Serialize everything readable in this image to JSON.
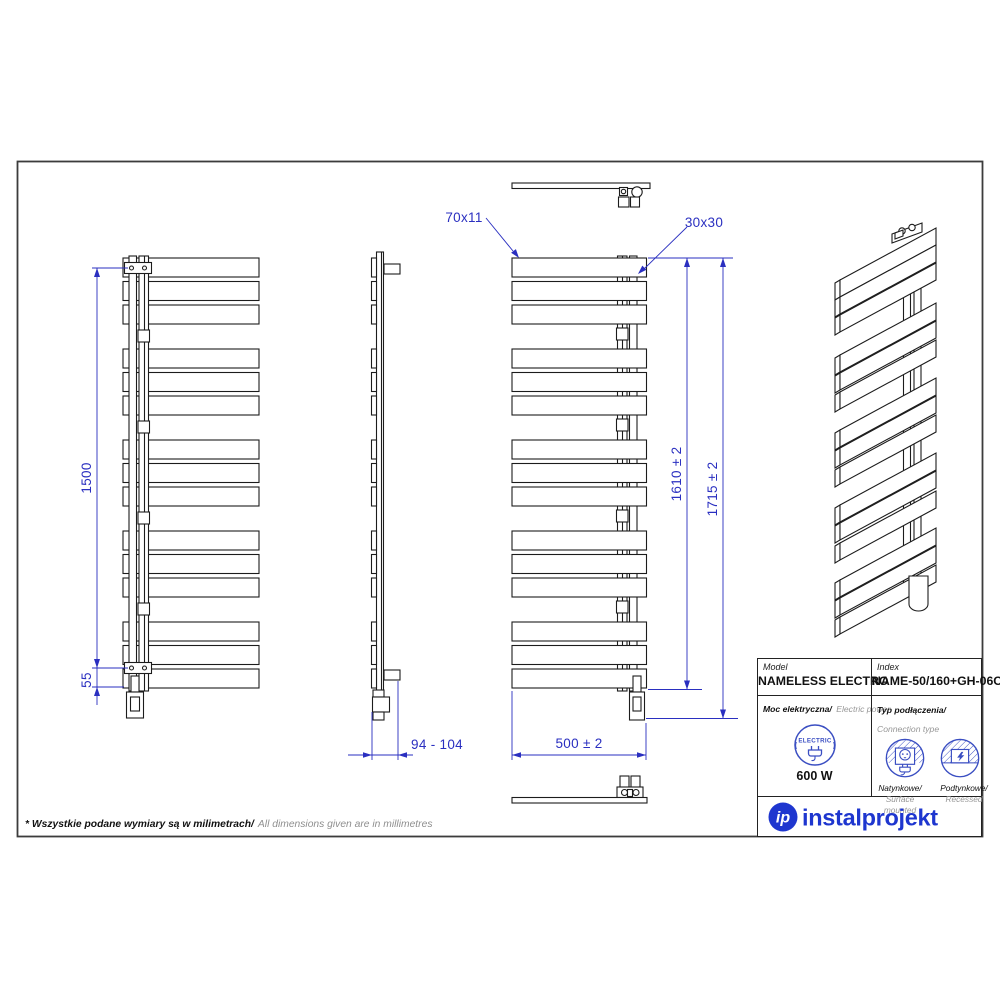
{
  "dimensions": {
    "mounting_height": "1500",
    "bottom_offset": "55",
    "wall_distance": "94 - 104",
    "width": "500 ± 2",
    "body_height": "1610 ± 2",
    "total_height": "1715 ± 2",
    "panel_profile": "70x11",
    "collector_profile": "30x30"
  },
  "title_block": {
    "model_label": "Model",
    "model_value": "NAMELESS ELECTRO",
    "index_label": "Index",
    "index_value": "NAME-50/160+GH-06C1",
    "power_label_pl": "Moc elektryczna/",
    "power_label_en": "Electric power",
    "electric_badge": "ELECTRIC",
    "power_value": "600 W",
    "connection_label_pl": "Typ podłączenia/",
    "connection_label_en": "Connection type",
    "surface_label_pl": "Natynkowe/",
    "surface_label_en": "Surface mounted",
    "recessed_label_pl": "Podtynkowe/",
    "recessed_label_en": "Recessed",
    "brand_monogram": "ip",
    "brand_name": "instalprojekt"
  },
  "footnote": {
    "pl": "* Wszystkie podane wymiary są w milimetrach/",
    "en": "All dimensions given are in millimetres"
  },
  "colors": {
    "dimension_blue": "#2a2fc0",
    "icon_blue": "#3a4ec2",
    "brand_blue": "#1e36cf",
    "line_black": "#1c1c1c",
    "muted_gray": "#979797"
  }
}
